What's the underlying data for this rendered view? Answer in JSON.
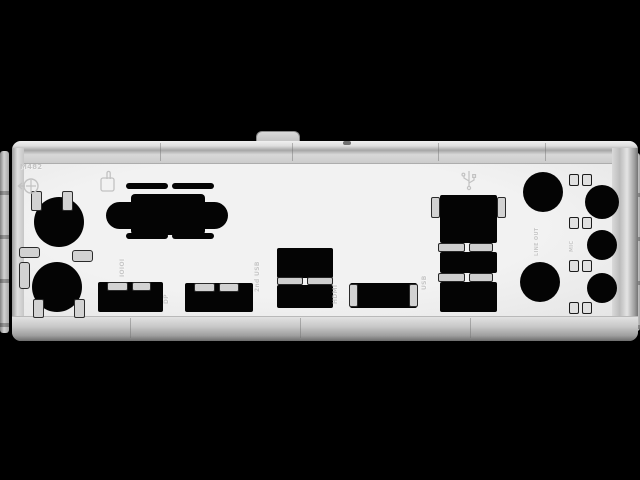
{
  "scene": {
    "background_color": "#000000",
    "subject": "Motherboard rear I/O shield backplate, brushed silver metal, product photo with black letterbox bars"
  },
  "shield": {
    "face_color": "#efefef",
    "frame_color": "#cfcfcf",
    "cutout_color": "#040404",
    "markings": {
      "part_number": "M482",
      "serial_label": "IOIOI",
      "dp_label": "DP",
      "usb2_label": "2nd USB",
      "hdmi_label": "HDMI",
      "usb_label": "USB",
      "audio_label_1": "LINE OUT",
      "audio_label_2": "MIC"
    },
    "icons": {
      "ps2": "ps2-keyboard-mouse-icon",
      "touch": "embossed-hand-icon",
      "usb": "usb-trident-icon"
    }
  }
}
